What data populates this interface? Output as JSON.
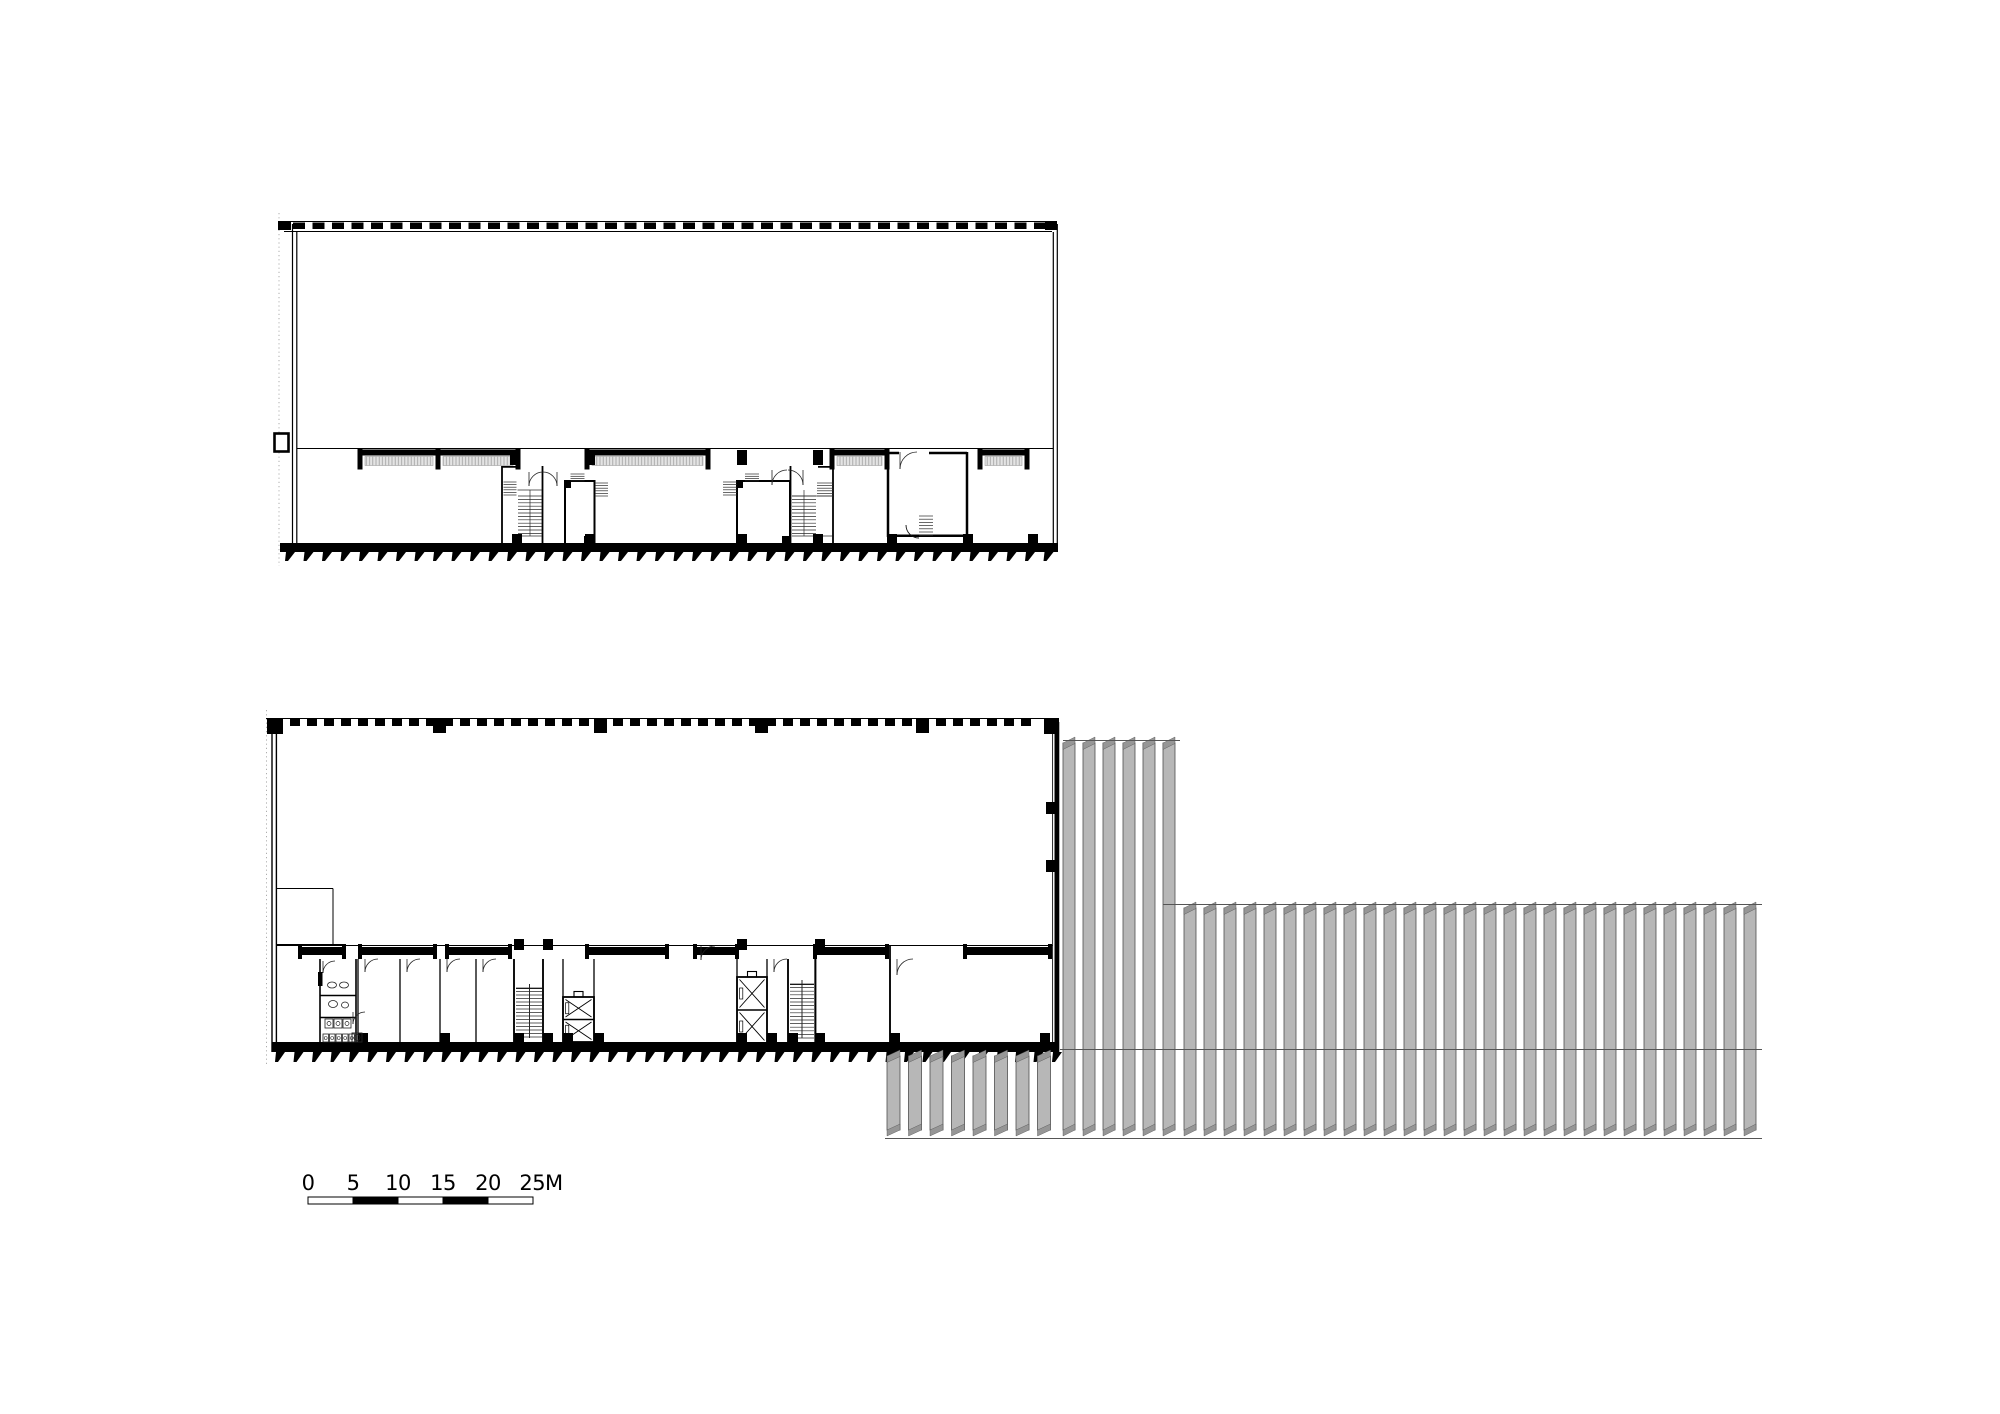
{
  "colors": {
    "ink": "#000000",
    "louver_fill": "#b7b7b7",
    "louver_cap": "#969696",
    "louver_edge": "#4f4f4f",
    "sill_line": "#9e9e9e"
  },
  "scale_bar": {
    "labels": [
      "0",
      "5",
      "10",
      "15",
      "20",
      "25M"
    ],
    "x": 308,
    "y": 1197,
    "segment_px": 45,
    "segments": 5,
    "bar_height": 7
  },
  "upper_plan": {
    "top_dashes": {
      "x1": 293,
      "x2": 1046,
      "y": 222.5,
      "h": 6.5,
      "pitch": 19.5,
      "dash": 12
    },
    "corner_blocks": [
      [
        278,
        221,
        13,
        9
      ],
      [
        1045,
        221,
        12,
        9
      ]
    ],
    "windows": [
      [
        360,
        78
      ],
      [
        438,
        80
      ],
      [
        587,
        121
      ],
      [
        832,
        55
      ],
      [
        980,
        47
      ]
    ],
    "front_blocks": [
      [
        510,
        450,
        10,
        15
      ],
      [
        585,
        450,
        10,
        15
      ],
      [
        737,
        450,
        10,
        15
      ],
      [
        813,
        450,
        10,
        15
      ]
    ],
    "bottom_columns": [
      [
        512,
        534,
        10,
        11
      ],
      [
        585,
        534,
        10,
        11
      ],
      [
        737,
        534,
        10,
        11
      ],
      [
        813,
        534,
        10,
        11
      ],
      [
        887,
        534,
        10,
        11
      ],
      [
        963,
        534,
        10,
        11
      ],
      [
        1028,
        534,
        10,
        11
      ]
    ],
    "blocks": [
      [
        565,
        481,
        6,
        7
      ],
      [
        584,
        536,
        10,
        8
      ],
      [
        737,
        481,
        6,
        7
      ],
      [
        782,
        536,
        8,
        8
      ]
    ],
    "ticks": {
      "x1": 286,
      "x2": 1055,
      "y": 552,
      "pitch": 18.5,
      "tw": 9,
      "th": 9
    },
    "treads": [
      {
        "x": 503.5,
        "y": 482,
        "w": 13,
        "h": 15,
        "step": 2.6
      },
      {
        "x": 518,
        "y": 496,
        "w": 24,
        "h": 40,
        "step": 3.4
      },
      {
        "x": 595,
        "y": 483,
        "w": 13,
        "h": 14,
        "step": 2.6
      },
      {
        "x": 570.5,
        "y": 474,
        "w": 14,
        "h": 9,
        "step": 2.3
      },
      {
        "x": 723,
        "y": 482,
        "w": 14,
        "h": 15,
        "step": 2.6
      },
      {
        "x": 745,
        "y": 474,
        "w": 14,
        "h": 9,
        "step": 2.3
      },
      {
        "x": 792,
        "y": 496,
        "w": 24,
        "h": 40,
        "step": 3.4
      },
      {
        "x": 817,
        "y": 483,
        "w": 16,
        "h": 14,
        "step": 2.6
      },
      {
        "x": 919,
        "y": 516,
        "w": 14,
        "h": 22,
        "step": 3.2
      }
    ],
    "door_arcs": [
      {
        "x": 529,
        "y": 472,
        "r": 14,
        "f": 0
      },
      {
        "x": 557,
        "y": 472,
        "r": 14,
        "f": 1
      },
      {
        "x": 772,
        "y": 470,
        "r": 15,
        "f": 0
      },
      {
        "x": 803,
        "y": 470,
        "r": 15,
        "f": 1
      },
      {
        "x": 900,
        "y": 452,
        "r": 17,
        "f": 0
      }
    ]
  },
  "lower_plan": {
    "top_dashes": {
      "x1": 290,
      "x2": 1042,
      "y": 719,
      "h": 7,
      "pitch": 17,
      "dash": 10
    },
    "corner_blocks": [
      [
        267,
        718,
        16,
        16
      ],
      [
        1044,
        718,
        15,
        16
      ]
    ],
    "top_columns": [
      [
        433,
        718,
        13,
        15
      ],
      [
        594,
        718,
        13,
        15
      ],
      [
        755,
        718,
        13,
        15
      ],
      [
        916,
        718,
        13,
        15
      ]
    ],
    "right_wall_marks": [
      [
        1046,
        802,
        9,
        12
      ],
      [
        1046,
        860,
        9,
        12
      ]
    ],
    "windows": [
      [
        300,
        44
      ],
      [
        360,
        75
      ],
      [
        447,
        63
      ],
      [
        587,
        80
      ],
      [
        695,
        42
      ],
      [
        815,
        72
      ],
      [
        965,
        85
      ]
    ],
    "front_columns": [
      [
        514,
        939,
        10,
        11
      ],
      [
        543,
        939,
        10,
        11
      ],
      [
        737,
        939,
        10,
        11
      ],
      [
        815,
        939,
        10,
        11
      ]
    ],
    "partitions": [
      358,
      400,
      440,
      476,
      514,
      543,
      563,
      594,
      737,
      767,
      788,
      815,
      890
    ],
    "door_arcs": [
      {
        "x": 365,
        "y": 959,
        "r": 13,
        "f": 0
      },
      {
        "x": 407,
        "y": 959,
        "r": 13,
        "f": 0
      },
      {
        "x": 447,
        "y": 959,
        "r": 13,
        "f": 0
      },
      {
        "x": 483,
        "y": 959,
        "r": 13,
        "f": 0
      },
      {
        "x": 774,
        "y": 959,
        "r": 13,
        "f": 0
      },
      {
        "x": 897,
        "y": 959,
        "r": 16,
        "f": 0
      },
      {
        "x": 323,
        "y": 961,
        "r": 12,
        "f": 0
      },
      {
        "x": 353,
        "y": 1012,
        "r": 12,
        "f": 0
      },
      {
        "x": 701,
        "y": 946,
        "r": 14,
        "f": 0
      }
    ],
    "treads": [
      {
        "x": 516,
        "y": 988,
        "w": 26,
        "h": 50,
        "step": 3.5
      },
      {
        "x": 790,
        "y": 984,
        "w": 24,
        "h": 54,
        "step": 3.6
      }
    ],
    "elevators": [
      {
        "x": 563,
        "y": 997,
        "w": 31,
        "h": 45
      },
      {
        "x": 737,
        "y": 977,
        "w": 30,
        "h": 66
      }
    ],
    "bottom_columns": [
      [
        358,
        1033,
        10,
        10
      ],
      [
        440,
        1033,
        10,
        10
      ],
      [
        514,
        1033,
        10,
        10
      ],
      [
        543,
        1033,
        10,
        10
      ],
      [
        563,
        1033,
        10,
        10
      ],
      [
        594,
        1033,
        10,
        10
      ],
      [
        737,
        1033,
        10,
        10
      ],
      [
        767,
        1033,
        10,
        10
      ],
      [
        788,
        1033,
        10,
        10
      ],
      [
        815,
        1033,
        10,
        10
      ],
      [
        890,
        1033,
        10,
        10
      ],
      [
        1040,
        1033,
        10,
        10
      ]
    ],
    "ticks": {
      "x1": 276,
      "x2": 1056,
      "y": 1052,
      "pitch": 18.5,
      "tw": 9,
      "th": 10
    },
    "toilet_fixtures": {
      "ellipses": [
        [
          332,
          985,
          4.5,
          3
        ],
        [
          344,
          985,
          4.5,
          3
        ],
        [
          333,
          1004,
          4.5,
          3.5
        ],
        [
          345,
          1005,
          3.5,
          3
        ]
      ],
      "stalls": [
        [
          325,
          1019,
          8,
          9
        ],
        [
          334,
          1019,
          8,
          9
        ],
        [
          343,
          1019,
          8,
          9
        ]
      ],
      "bottom_row_x": 323,
      "bottom_row_y": 1034,
      "bottom_row_n": 5,
      "box": [
        352,
        1033,
        10,
        9
      ]
    }
  },
  "louvers": {
    "groups": [
      {
        "x": 1063,
        "y": 737,
        "w": 12,
        "pitch": 20,
        "count": 6,
        "h": 399
      },
      {
        "x": 1184,
        "y": 902,
        "w": 12,
        "pitch": 20,
        "count": 29,
        "h": 234
      },
      {
        "x": 887,
        "y": 1050,
        "w": 13,
        "pitch": 21.5,
        "count": 8,
        "h": 86
      }
    ],
    "lines": [
      [
        1063,
        740.5,
        1180,
        740.5
      ],
      [
        1163,
        904.5,
        1762,
        904.5
      ],
      [
        1060,
        1049.5,
        1762,
        1049.5
      ],
      [
        885,
        1138.5,
        1762,
        1138.5
      ]
    ]
  }
}
